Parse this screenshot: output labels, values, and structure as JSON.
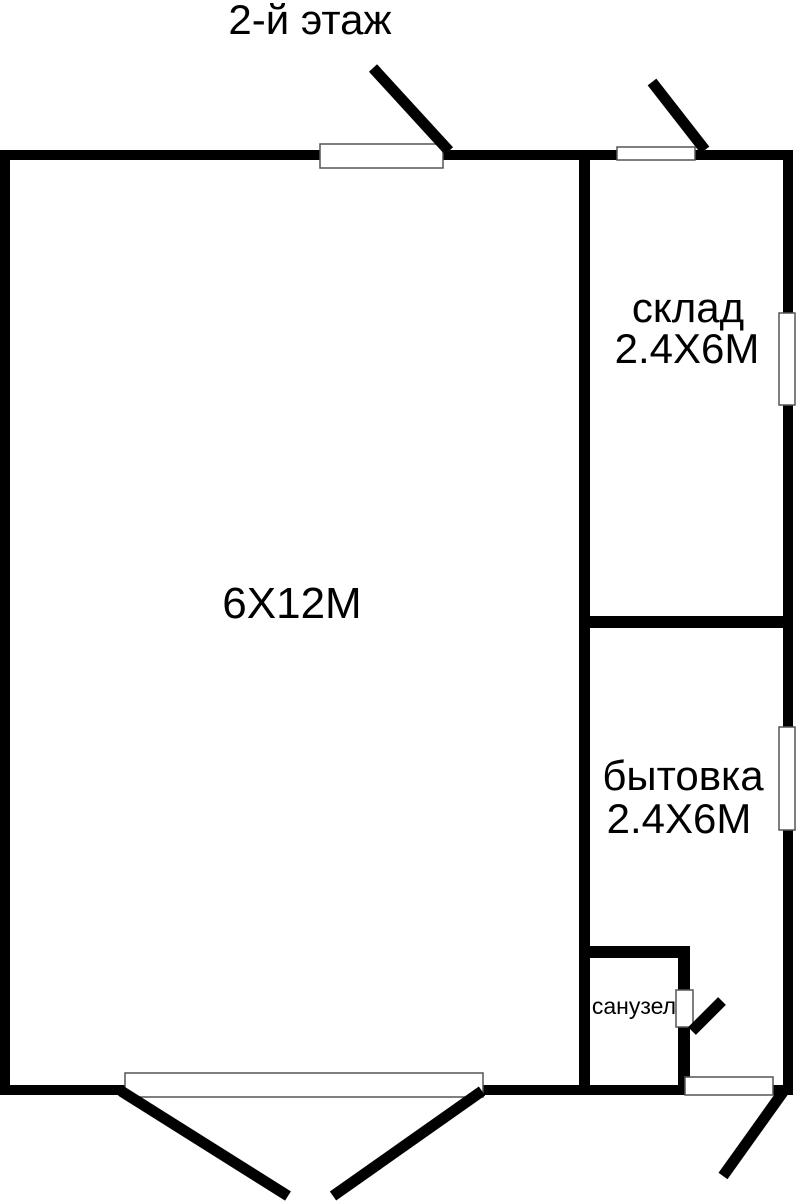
{
  "plan": {
    "title": "2-й этаж",
    "rooms": {
      "main": {
        "label": "6Х12М"
      },
      "storage": {
        "name": "склад",
        "size": "2.4Х6М"
      },
      "utility": {
        "name": "бытовка",
        "size": "2.4Х6М"
      },
      "bathroom": {
        "name": "санузел"
      }
    },
    "colors": {
      "wall": "#000000",
      "background": "#ffffff",
      "opening_fill": "#ffffff",
      "opening_border": "#555555"
    }
  }
}
